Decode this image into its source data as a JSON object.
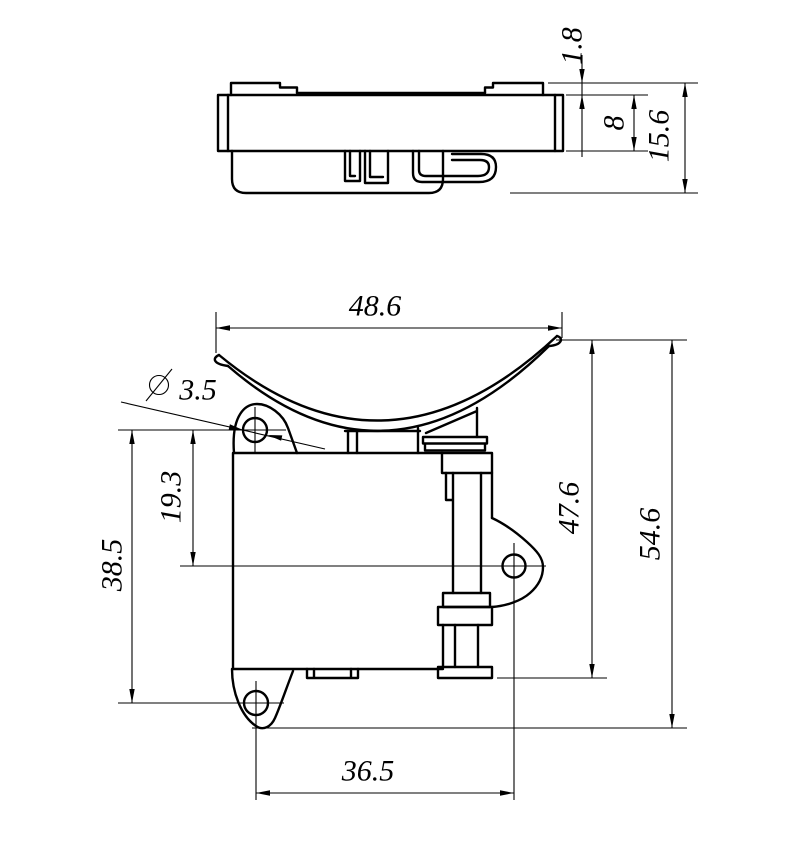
{
  "drawing": {
    "type": "engineering-drawing",
    "background": "#ffffff",
    "line_color": "#000000",
    "views": {
      "side_view": {
        "name": "side profile view",
        "dimensions": {
          "lip_height": "1.8",
          "plate_thickness": "8",
          "overall_thickness": "15.6"
        }
      },
      "front_view": {
        "name": "front view",
        "diameter_symbol": "∅",
        "dimensions": {
          "cradle_width": "48.6",
          "hole_diameter": "3.5",
          "upper_hole_to_ear_hole": "19.3",
          "upper_to_lower_hole": "38.5",
          "cradle_to_rail_bottom": "47.6",
          "overall_height": "54.6",
          "lower_hole_to_ear_hole": "36.5"
        }
      }
    }
  }
}
